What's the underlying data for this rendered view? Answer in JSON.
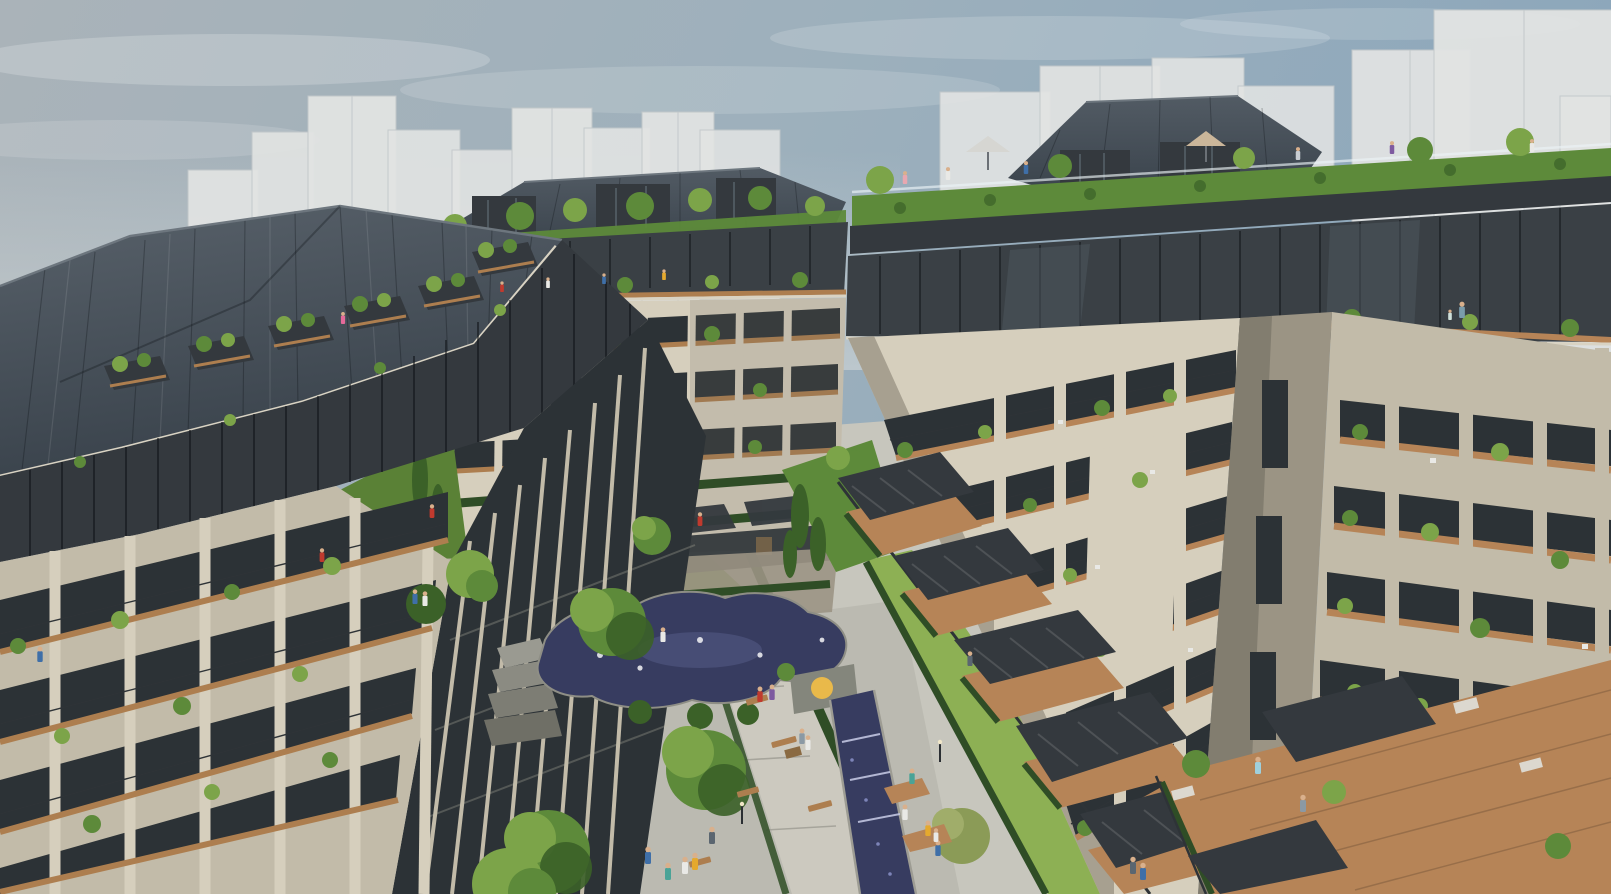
{
  "scene": {
    "type": "architectural-rendering",
    "title": "Aerial view of a modern residential complex with landscaped courtyard",
    "description": "Daytime 3D visualization seen from above: three mid-rise apartment buildings with dark standing-seam metal roofs, beige stone facades and timber balconies surround a landscaped courtyard with an organic sculpted pond, cascading stone weirs, a stepped water rill, lawns, trees, benches and strolling residents. Translucent white massing volumes of the surrounding city stand in the background under a hazy blue sky.",
    "time_of_day": "day",
    "sky": "hazy grey-blue with thin clouds",
    "camera": "elevated three-quarter aerial view"
  },
  "palette": {
    "sky_left": "#aab3b9",
    "sky_right": "#8ba6bb",
    "massing": "#e2e4e3",
    "massing_shade": "#d2d6d7",
    "massing_edge": "#c2c8ca",
    "roof_dark": "#47505a",
    "roof_ridge": "#6d767e",
    "cladding_dark": "#34393e",
    "facade_light": "#d6cfbd",
    "facade_mid": "#c2bba9",
    "facade_shade": "#9b9484",
    "window_dark": "#2c3236",
    "wood": "#ad7e4f",
    "deck": "#b68457",
    "green_bright": "#7ca449",
    "green_mid": "#5d8a3a",
    "green_dark": "#3b6128",
    "green_olive": "#8b9b57",
    "hedge_dark": "#2f4d26",
    "lawn": "#6f9d3f",
    "lawn_light": "#8db054",
    "paving": "#c7c6bd",
    "paving_mid": "#b3b2a9",
    "paving_dark": "#9d9c93",
    "water": "#373c60",
    "water_hi": "#585e8a",
    "water_foam": "#c9cde8",
    "accent_yellow": "#e9b94a",
    "skin": "#d9b08c"
  },
  "background": {
    "massing_blocks": 16,
    "style": "translucent white context volumes"
  },
  "buildings": {
    "left": {
      "roof": "dark standing-seam metal with recessed roof terraces",
      "roof_terraces": 6,
      "penthouse": "dark metal-clad setback level",
      "facade": "beige stone piers with wood-floored balconies",
      "side_face": "dark curtain wall with stone mullions"
    },
    "center": {
      "roof": "dark hipped metal roof",
      "rooftop_garden": true,
      "rooftop_pavilions": 3,
      "penthouse": "glass pavilion level with planted terrace",
      "lower_levels": "terraced duplexes with hedge parapets and slatted awnings"
    },
    "right": {
      "rooftop": "communal roof terrace with hedge parapet, trees, parasols and residents",
      "penthouse": "full-glass dark level with timber terrace",
      "wings": 2,
      "facade": "pale limestone grid with deep timber balconies and planters",
      "ground": "stepped pergola terraces descending to the courtyard"
    }
  },
  "courtyard": {
    "water_feature": "organic sculpted pond with cascading stone weirs and fountain jets",
    "water_channel": "stepped water rill flowing toward the foreground",
    "feature_wall": {
      "shape": "stone wall with circular cutout",
      "accent_color_key": "accent_yellow"
    },
    "lawns": 4,
    "trees": 14,
    "benches": 7,
    "picnic_tables": 1,
    "paths": "light granite paving with banded setts",
    "hedges": "clipped dark-green ribbons along paths"
  },
  "people": {
    "total_visible": 30,
    "locations": [
      "roof terraces",
      "balconies",
      "plaza",
      "garden paths",
      "water-side decks"
    ]
  },
  "parasols": [
    {
      "color_name": "grey",
      "color": "#d6d6d2"
    },
    {
      "color_name": "tan",
      "color": "#cbb69a"
    }
  ]
}
